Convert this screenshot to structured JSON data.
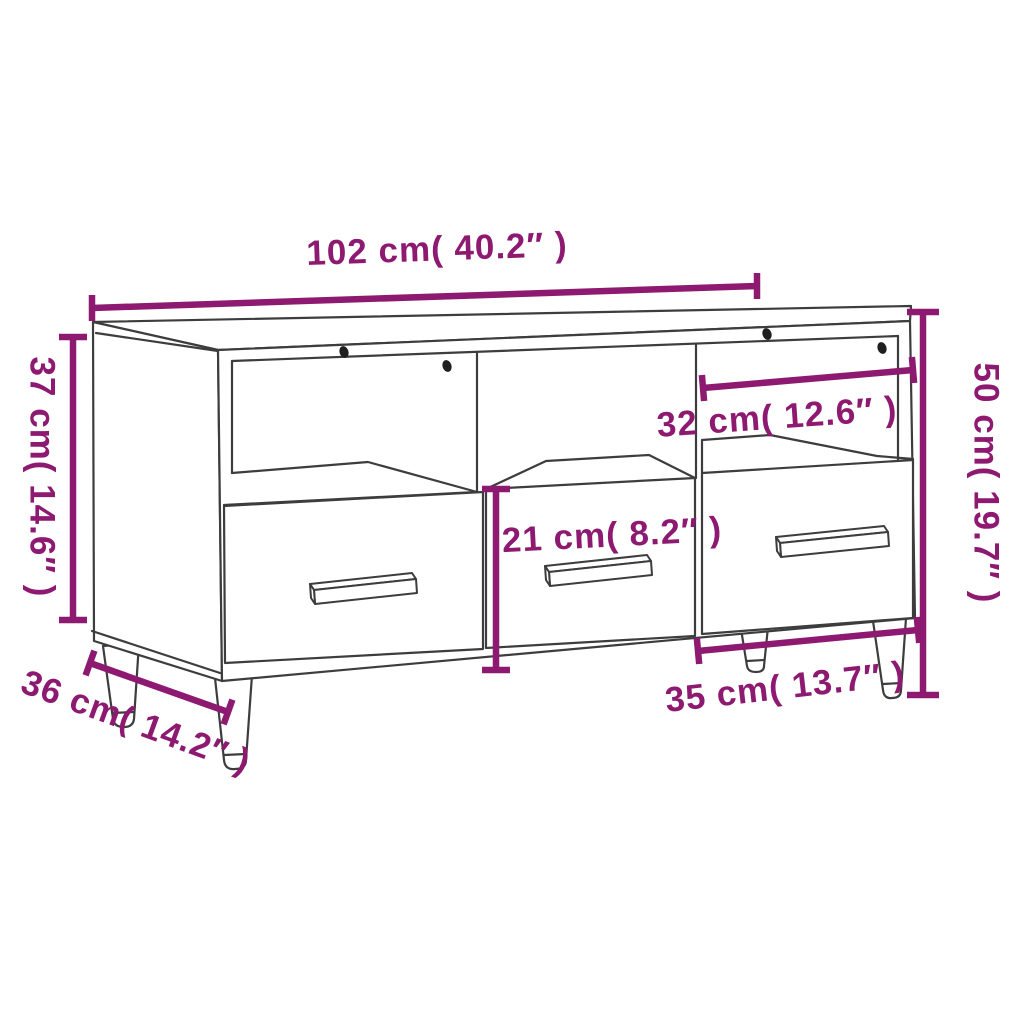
{
  "diagram": {
    "style": {
      "dimension_color": "#8d1a70",
      "outline_color": "#3d3d3d",
      "background": "#ffffff"
    },
    "labels": {
      "width": "102 cm( 40.2″ )",
      "height_left": "37 cm( 14.6″ )",
      "depth": "36 cm( 14.2″ )",
      "shelf_width": "32 cm( 12.6″ )",
      "drawer_height": "21 cm( 8.2″ )",
      "drawer_width": "35 cm( 13.7″ )",
      "height_right": "50 cm( 19.7″ )"
    }
  }
}
